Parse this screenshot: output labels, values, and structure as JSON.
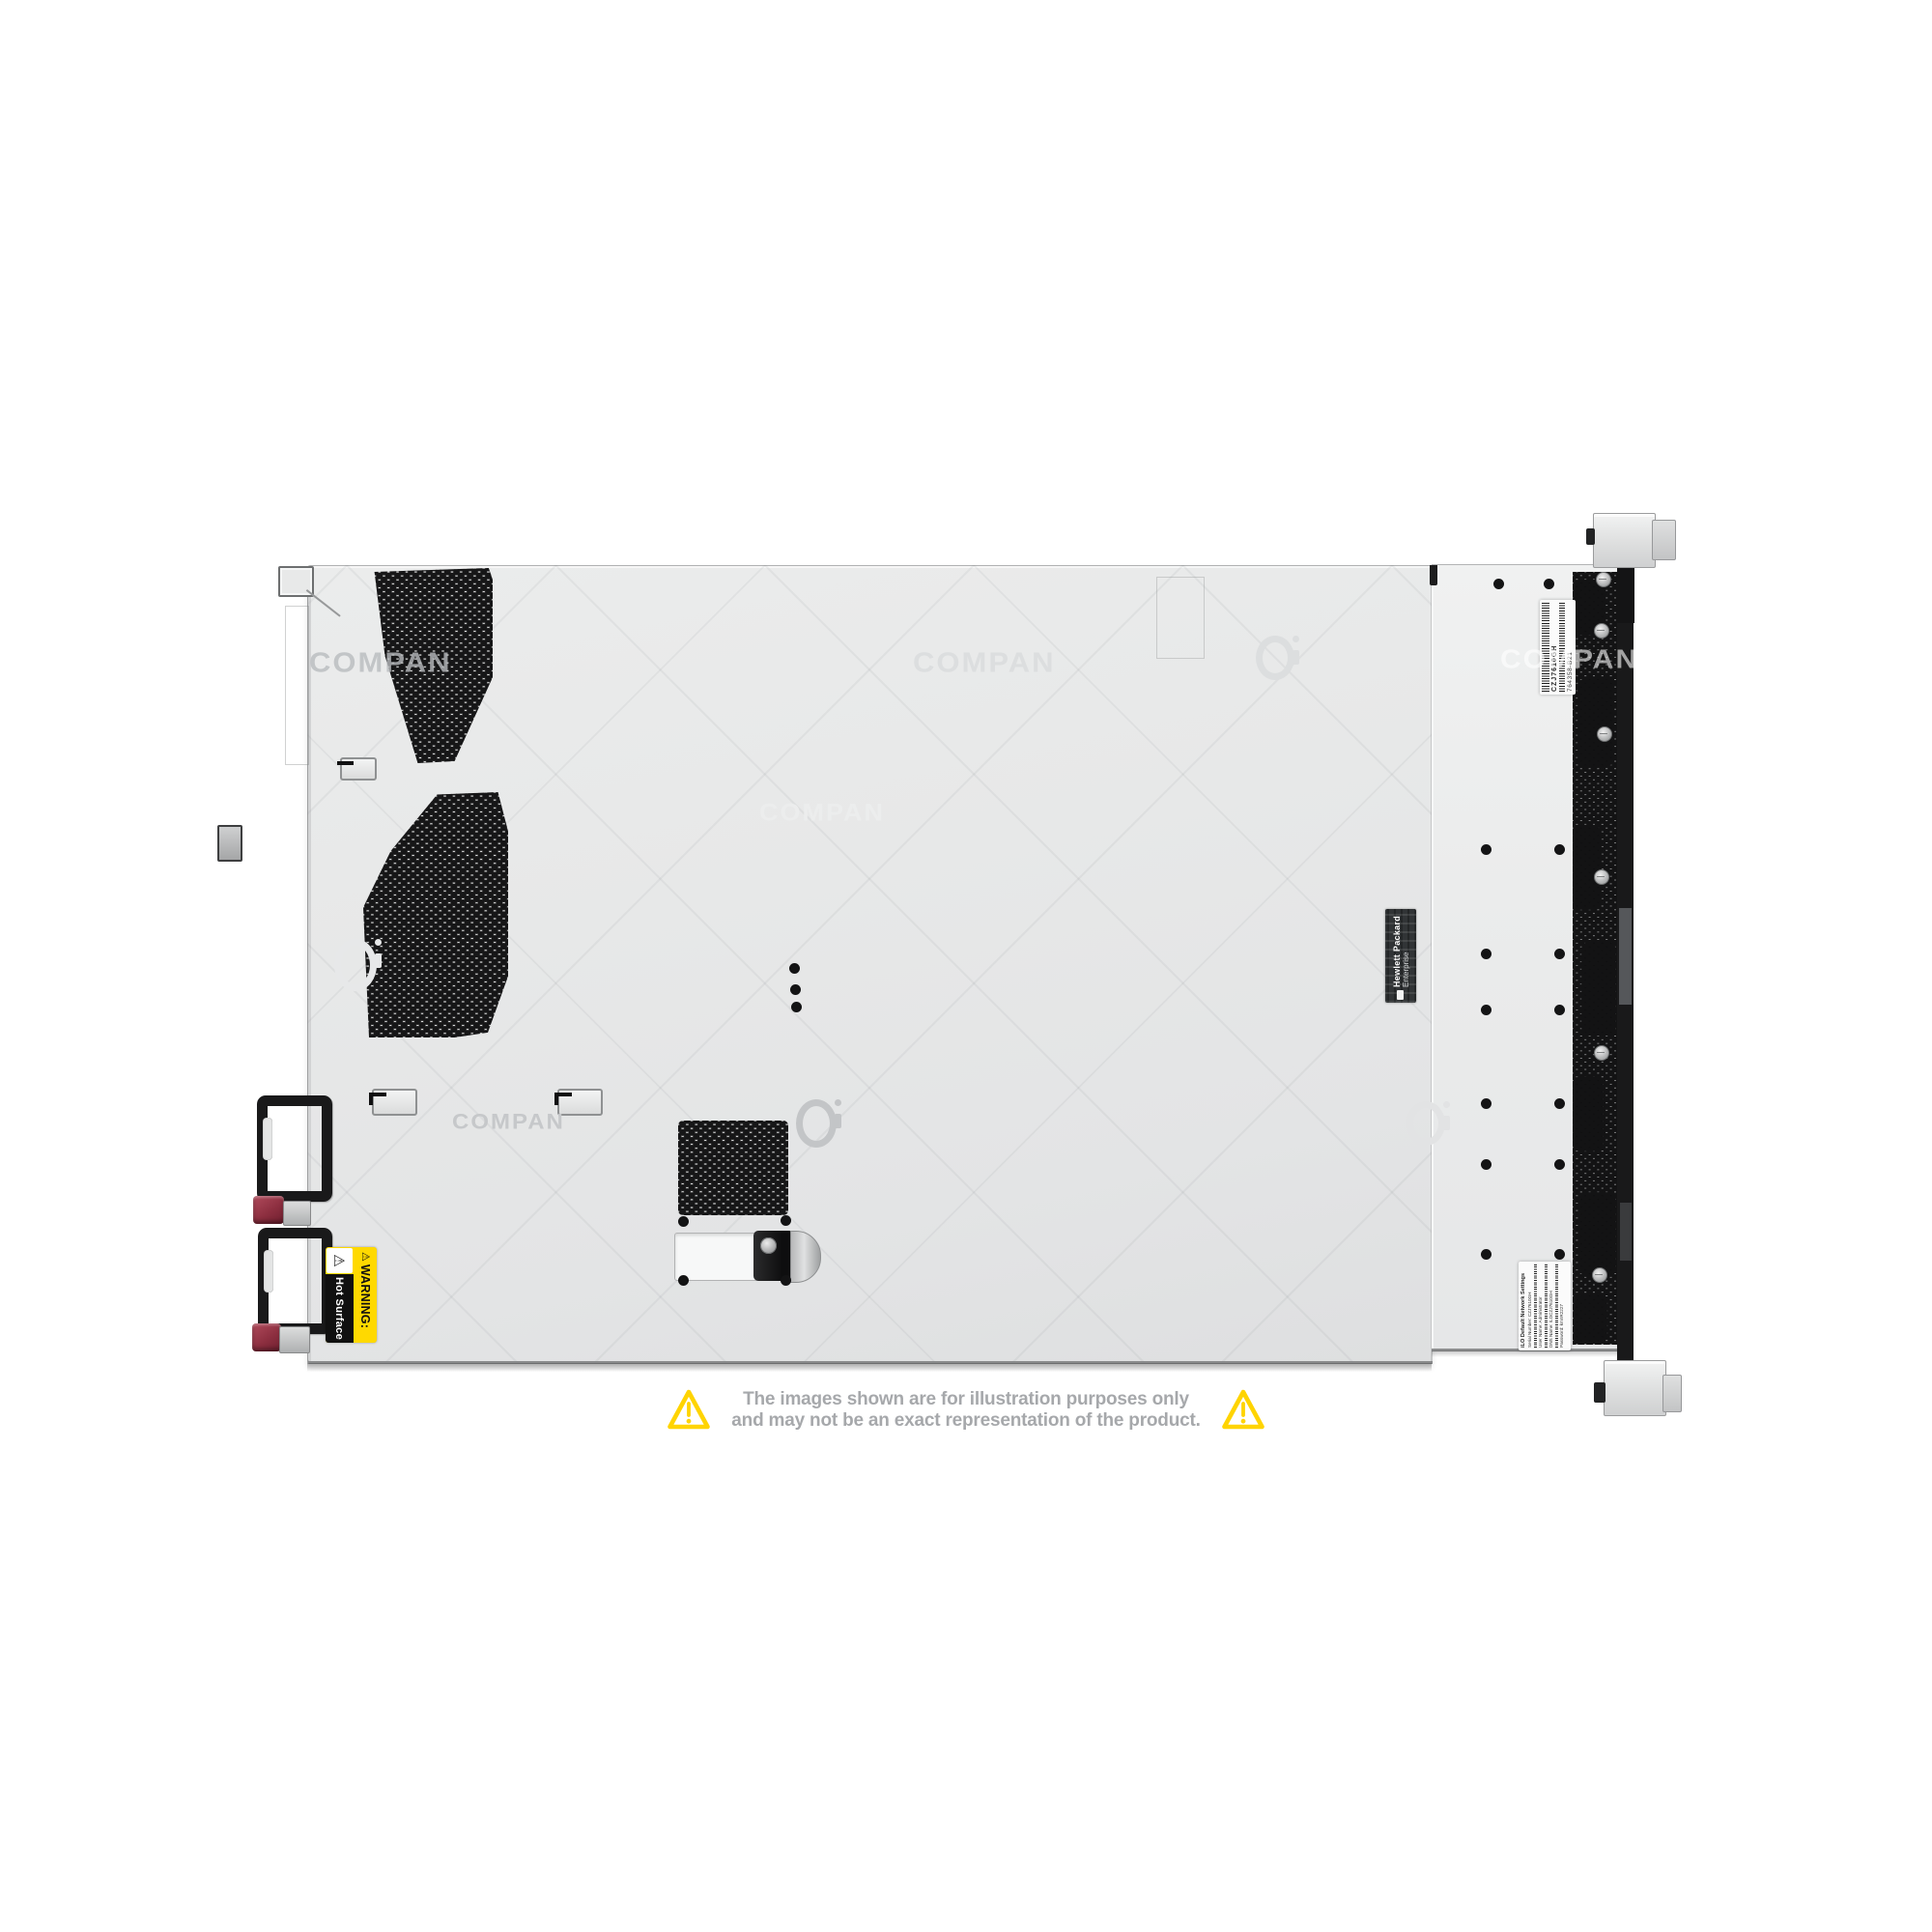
{
  "watermark": {
    "text": "COMPAN"
  },
  "disclaimer": {
    "line1": "The images shown are for illustration purposes only",
    "line2": "and may not be an exact representation of the product."
  },
  "chassis": {
    "labels": {
      "warning": {
        "icon": "⚠",
        "heading": "WARNING:",
        "body": "Hot Surface"
      },
      "brand": {
        "line1": "Hewlett Packard",
        "line2": "Enterprise"
      },
      "service_tag": {
        "serial": "CZJ7610GH",
        "part_number": "764358-B21"
      },
      "ilo": {
        "title": "iLO Default Network Settings",
        "lines": [
          "Serial Number: CZJ7610GH",
          "User Name: Administrator",
          "DNS Name: ILOCZJ7610GH",
          "Password: kmnR2227"
        ]
      }
    },
    "colors": {
      "body_gray": "#e8e9ea",
      "vent_hole_black": "#161617",
      "psu_latch_red": "#963445",
      "warning_yellow": "#ffd900",
      "disclaimer_yellow": "#ffd400",
      "disclaimer_text_gray": "#a6a8ab"
    }
  }
}
